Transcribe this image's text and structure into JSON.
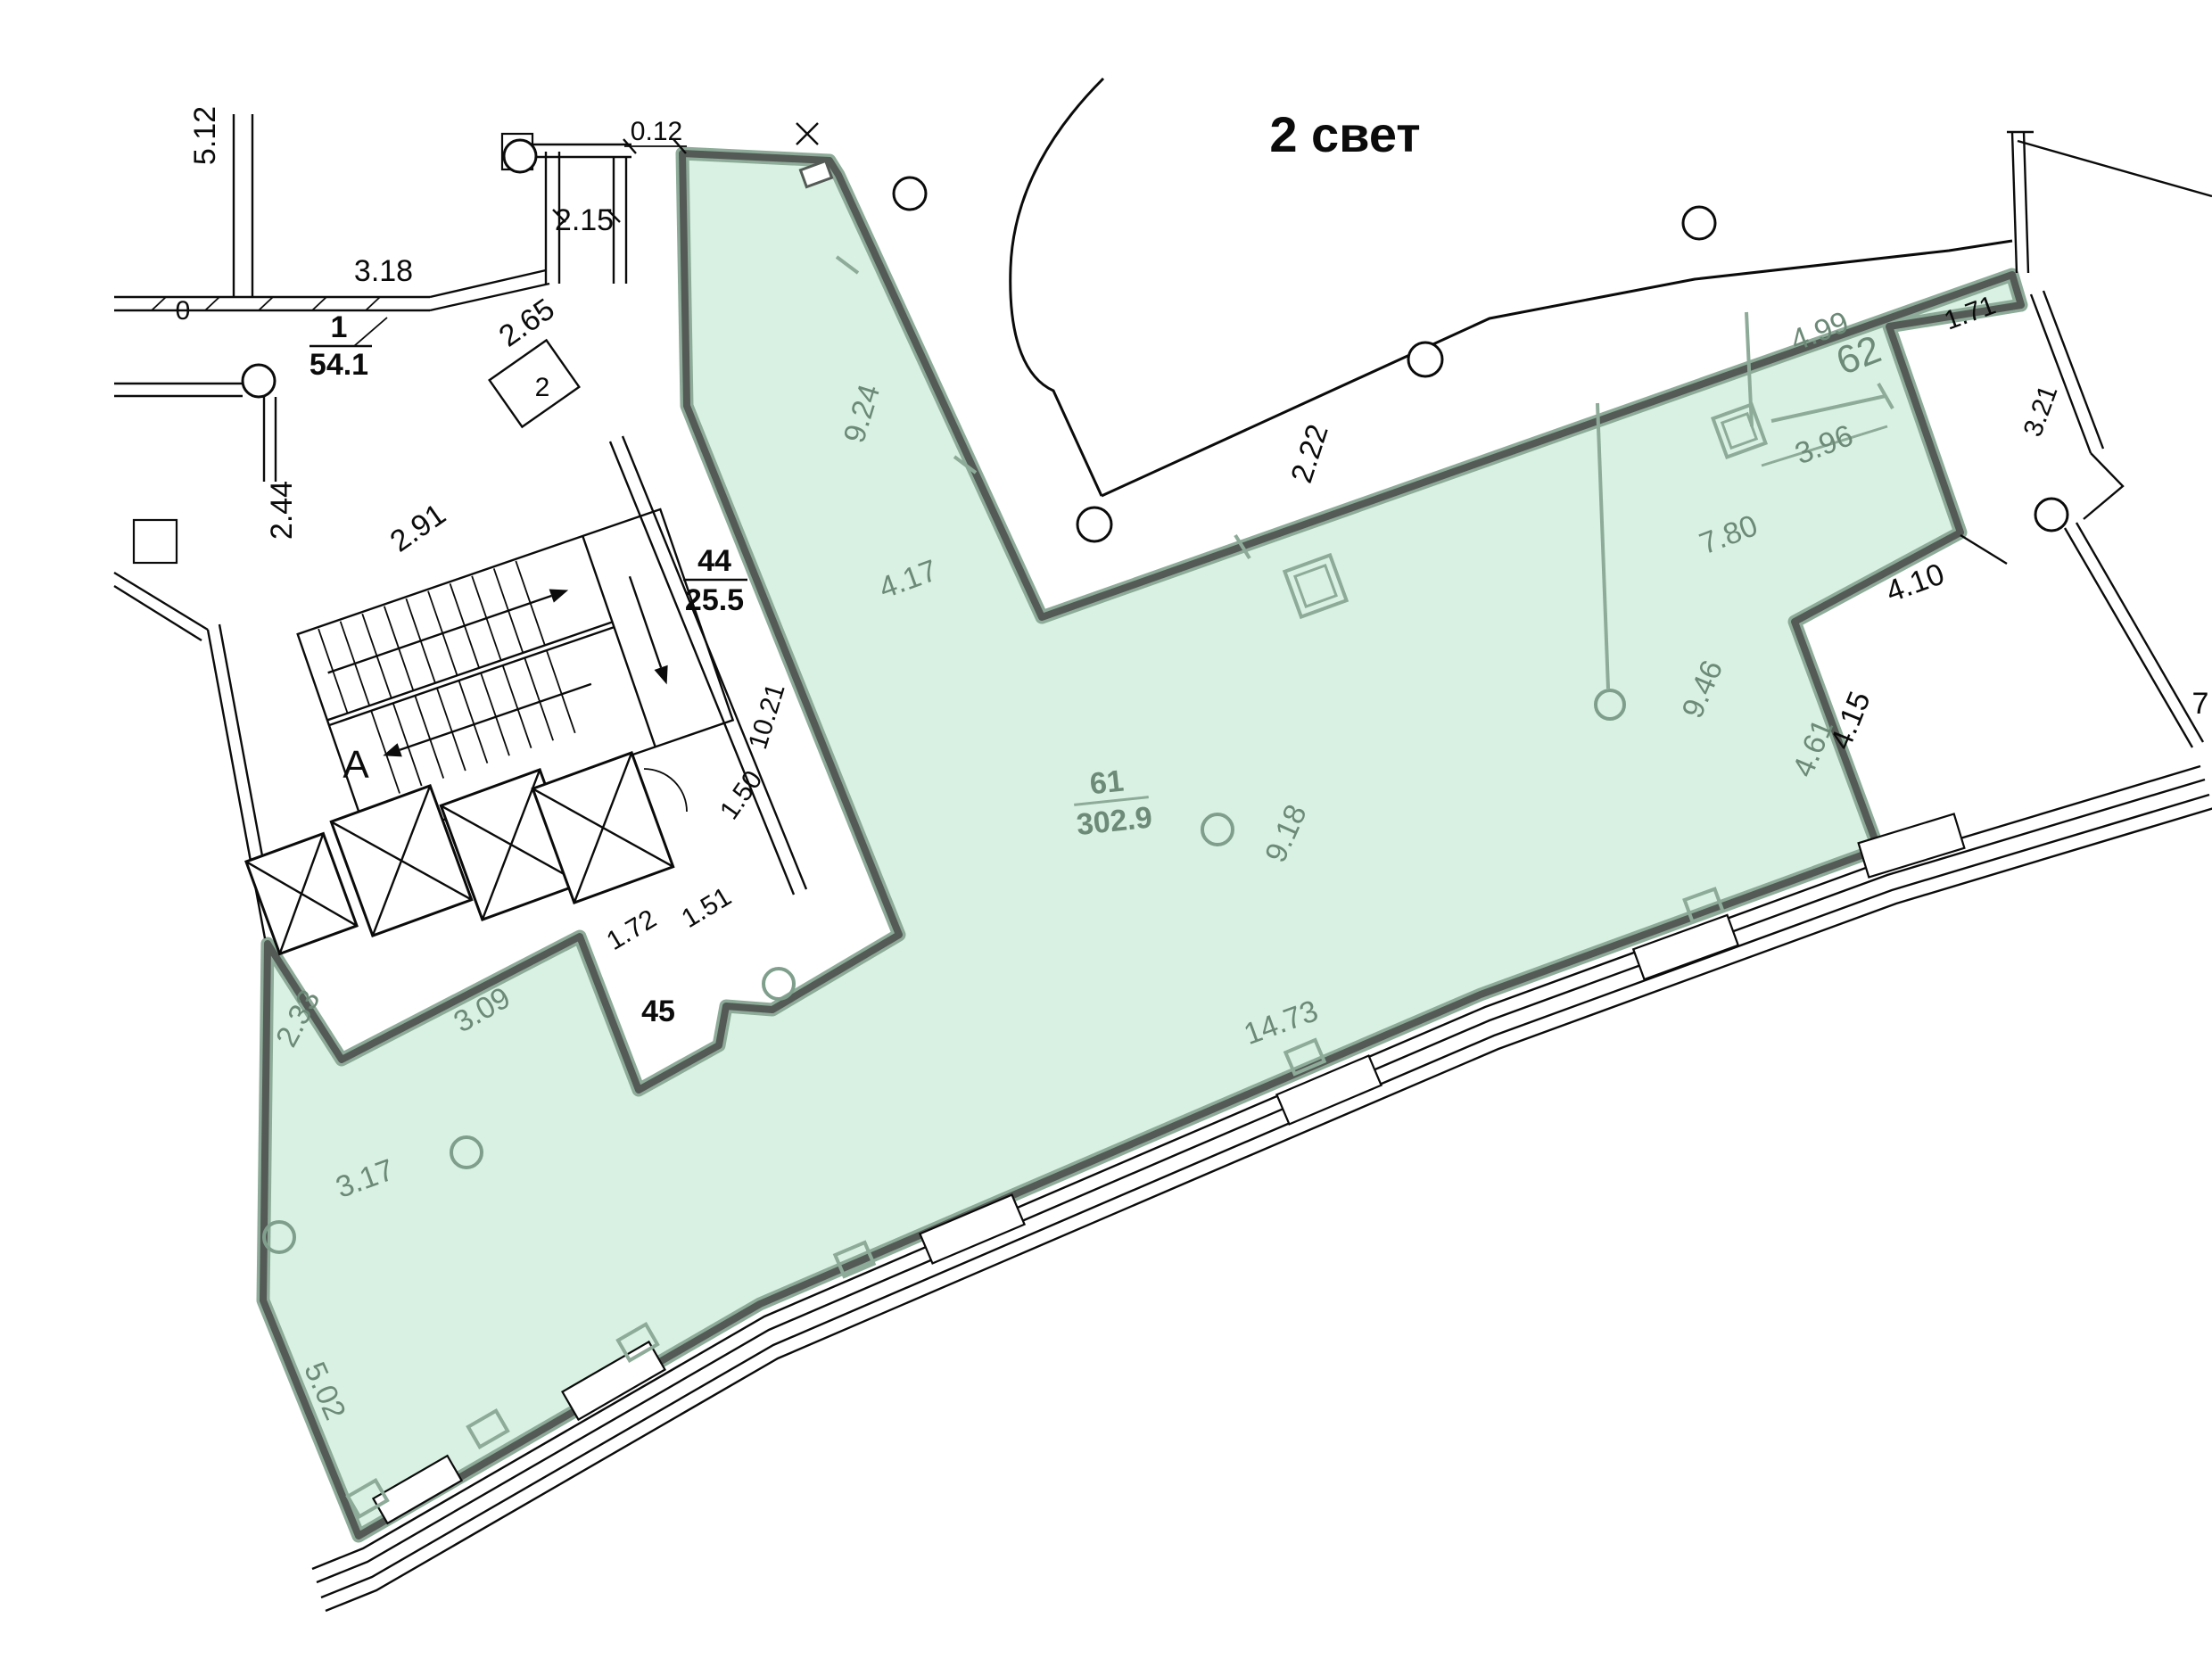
{
  "plan": {
    "atrium_label": "2 свет",
    "axis_label": "A",
    "rooms": {
      "room1": {
        "number": "1",
        "area": "54.1"
      },
      "room2": {
        "number": "2"
      },
      "room44": {
        "number": "44",
        "area": "25.5"
      },
      "room45": {
        "number": "45"
      },
      "room61": {
        "number": "61",
        "area": "302.9"
      },
      "room62": {
        "number": "62"
      }
    },
    "dims_black": {
      "d512": "5.12",
      "d318": "3.18",
      "d215": "2.15",
      "d012": "0.12",
      "d265": "2.65",
      "d244": "2.44",
      "d291": "2.91",
      "d1021": "10.21",
      "d150": "1.50",
      "d172": "1.72",
      "d151": "1.51",
      "d222": "2.22",
      "d171": "1.71",
      "d321": "3.21",
      "d410": "4.10",
      "d415": "4.15",
      "d7": "7",
      "d0": "0"
    },
    "dims_green": {
      "d924": "9.24",
      "d417": "4.17",
      "d918": "9.18",
      "d1473": "14.73",
      "d309": "3.09",
      "d233": "2.33",
      "d317": "3.17",
      "d502": "5.02",
      "d499": "4.99",
      "d396": "3.96",
      "d780": "7.80",
      "d946": "9.46",
      "d461": "4.61"
    },
    "colors": {
      "highlight_fill": "#d9f1e3",
      "wall_dark": "#545a56",
      "wall_sage": "#8dab98",
      "label_green": "#6c8a77",
      "line_black": "#0b0b0b"
    }
  }
}
